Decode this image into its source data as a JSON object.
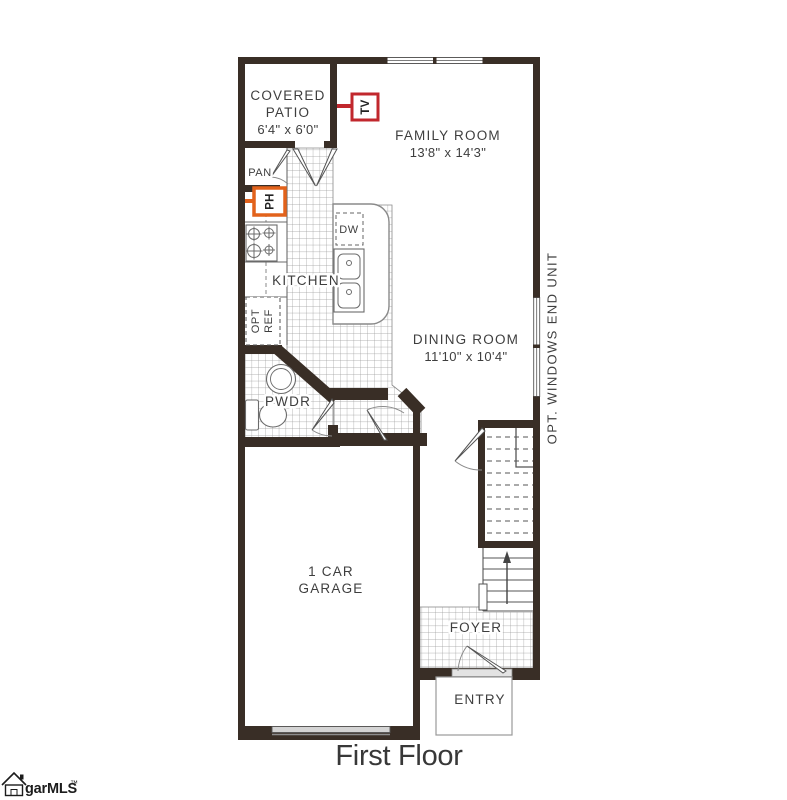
{
  "page": {
    "title": "First Floor"
  },
  "logo": {
    "name": "garMLS",
    "tm": "™"
  },
  "plan": {
    "rooms": {
      "covered_patio": {
        "line1": "COVERED",
        "line2": "PATIO",
        "dims": "6'4\" x 6'0\""
      },
      "family_room": {
        "name": "FAMILY ROOM",
        "dims": "13'8\" x 14'3\""
      },
      "dining_room": {
        "name": "DINING ROOM",
        "dims": "11'10\" x 10'4\""
      },
      "kitchen": {
        "name": "KITCHEN"
      },
      "pantry": {
        "name": "PAN"
      },
      "powder_room": {
        "name": "PWDR"
      },
      "garage": {
        "line1": "1 CAR",
        "line2": "GARAGE"
      },
      "foyer": {
        "name": "FOYER"
      },
      "entry": {
        "name": "ENTRY"
      }
    },
    "labels": {
      "dishwasher": "DW",
      "opt_ref_line1": "OPT",
      "opt_ref_line2": "REF",
      "opt_windows_note": "OPT. WINDOWS END UNIT"
    },
    "markers": {
      "tv": {
        "label": "TV",
        "color": "#c1272d"
      },
      "phone": {
        "label": "PH",
        "color": "#e2621b"
      }
    },
    "colors": {
      "wall": "#392e26",
      "window_fill": "#d4d4d4",
      "tile_line": "#9b9b9b",
      "fixture_line": "#6b6b6b",
      "text": "#3e3e3e"
    }
  }
}
